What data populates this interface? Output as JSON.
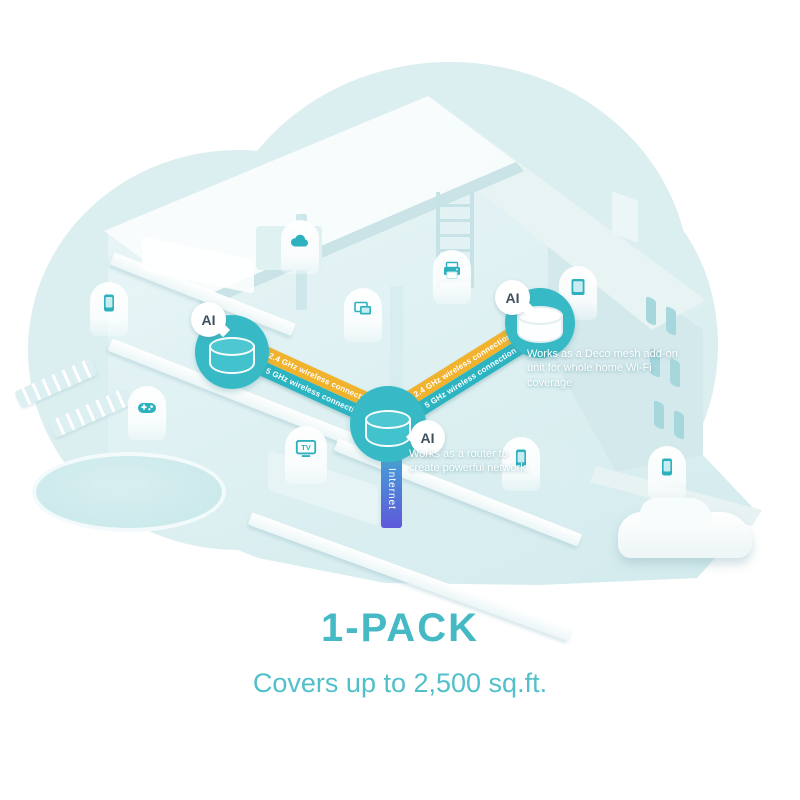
{
  "illustration": {
    "type": "mesh-wifi-home-coverage-diagram",
    "ai_badge_label": "AI",
    "internet_band": {
      "label": "Internet",
      "gradient_top": "#41a8d6",
      "gradient_bottom": "#5f58d9"
    },
    "bands": {
      "arrows_left": "‹‹‹",
      "arrows_right": "›››",
      "left": {
        "ghz24": {
          "label": "2.4 GHz wireless connection",
          "color": "#f1b32e"
        },
        "ghz5": {
          "label": "5 GHz wireless connection",
          "color": "#2cb4c1"
        }
      },
      "right": {
        "ghz24": {
          "label": "2.4 GHz wireless connection",
          "color": "#f1b32e"
        },
        "ghz5": {
          "label": "5 GHz wireless connection",
          "color": "#2cb4c1"
        }
      }
    },
    "notes": {
      "router": "Works as a router to create powerful network.",
      "mesh_addon": "Works as a Deco mesh add-on unit for whole home Wi-Fi coverage"
    },
    "devices": {
      "tv_label": "TV",
      "icons": [
        "smartphone-icon",
        "gamepad-icon",
        "cloud-icon",
        "laptop-icon",
        "printer-icon",
        "tv-icon",
        "tablet-icon",
        "smartphone-icon",
        "smartphone-icon"
      ]
    },
    "colors": {
      "accent_teal": "#2eb1be",
      "deco_circle": "#38bac6",
      "band_yellow": "#f1b32e",
      "band_teal": "#2cb4c1",
      "background_blob": "#dbeef0",
      "footer_text": "#45b9c4"
    }
  },
  "footer": {
    "pack_title": "1-PACK",
    "coverage_text": "Covers up to 2,500 sq.ft."
  }
}
